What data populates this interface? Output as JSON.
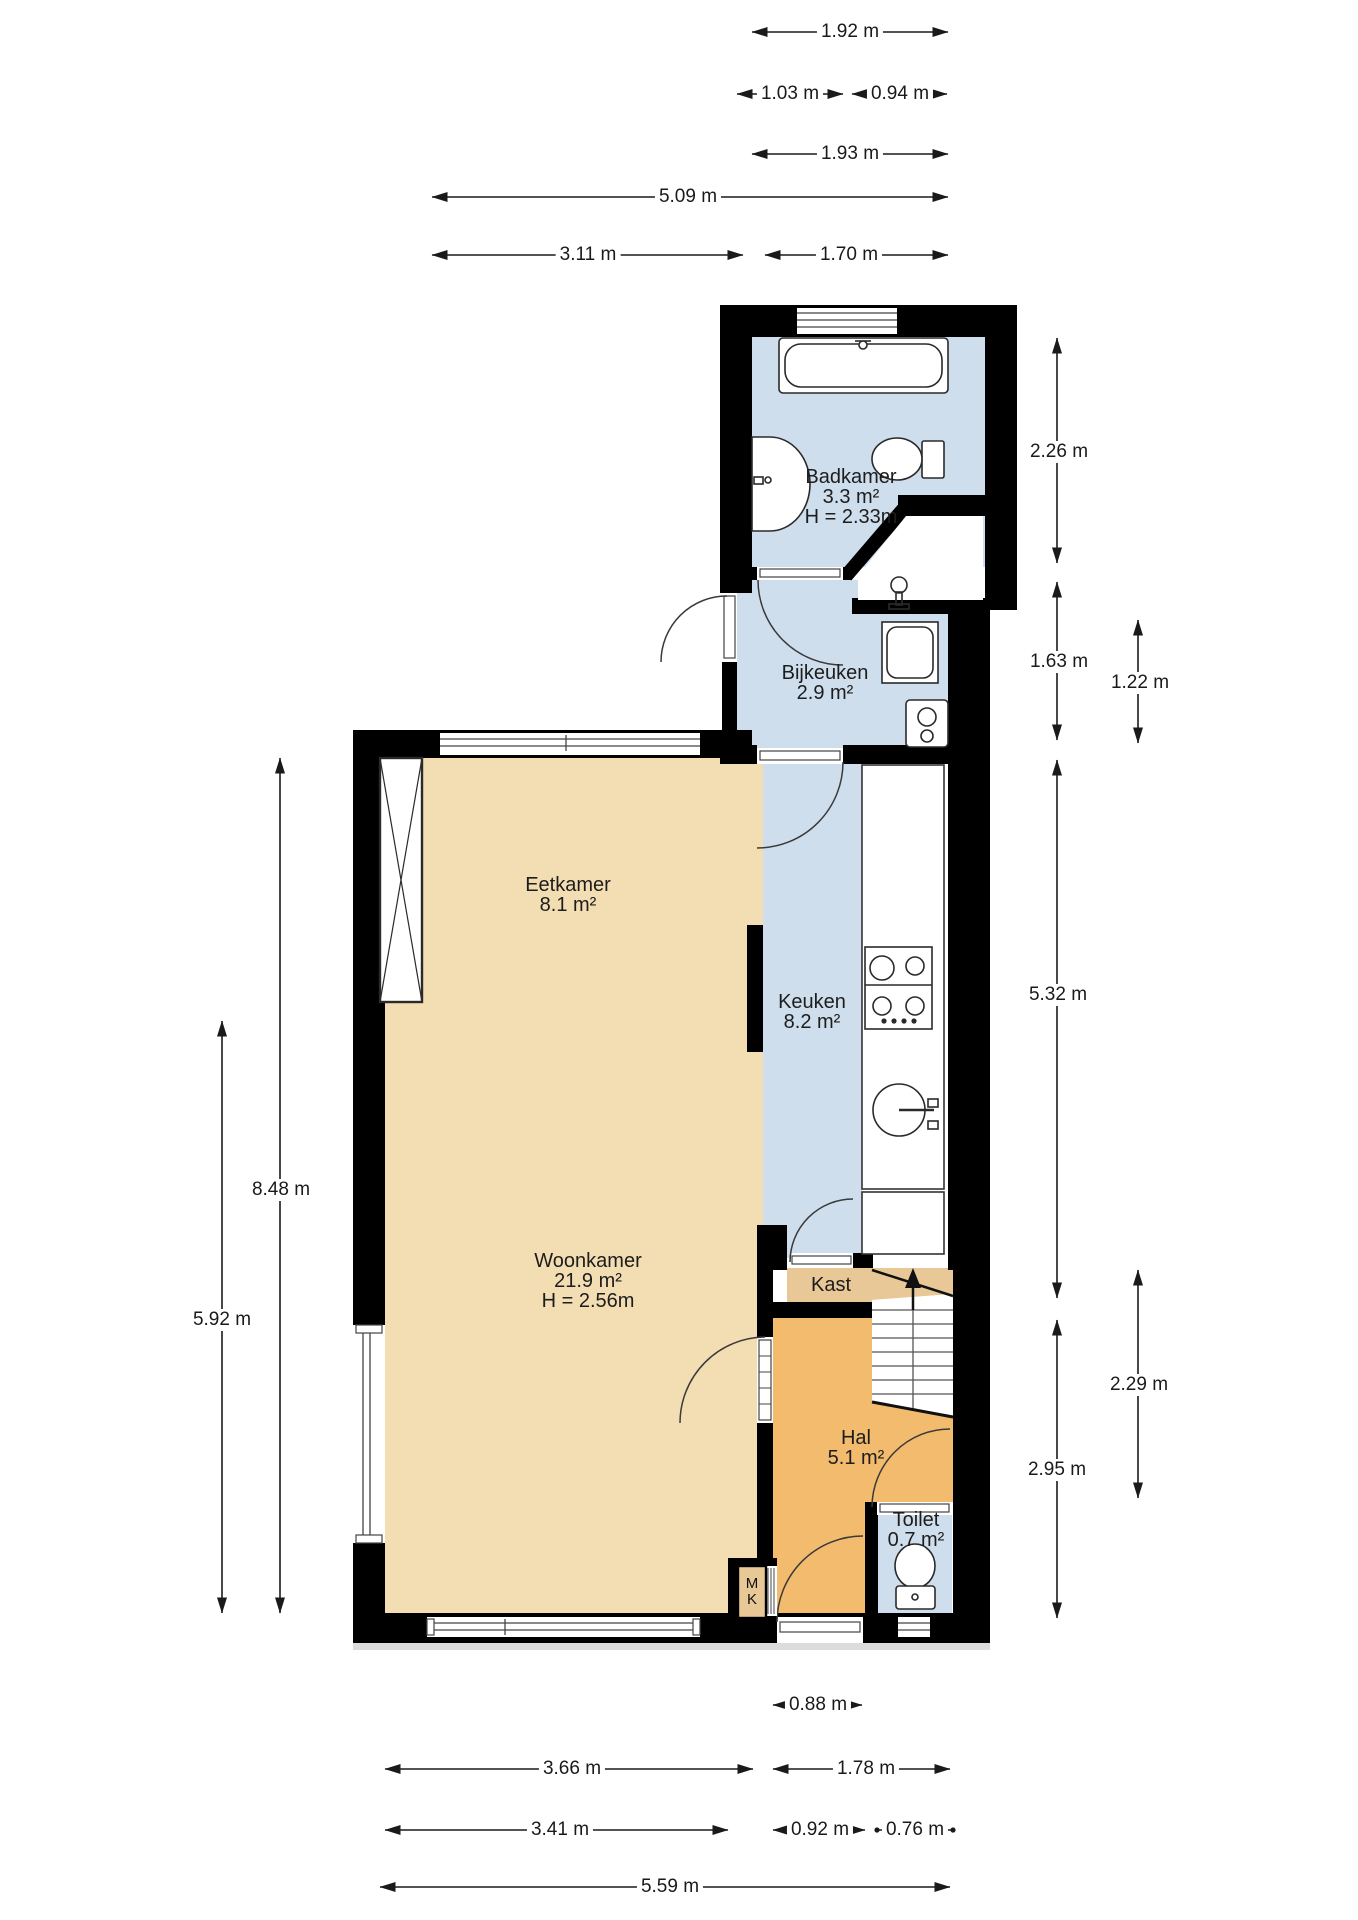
{
  "plan_type": "floorplan",
  "language": "nl",
  "rooms": {
    "badkamer": {
      "name": "Badkamer",
      "area": "3.3 m²",
      "ceiling": "H = 2.33m"
    },
    "bijkeuken": {
      "name": "Bijkeuken",
      "area": "2.9 m²"
    },
    "eetkamer": {
      "name": "Eetkamer",
      "area": "8.1 m²"
    },
    "keuken": {
      "name": "Keuken",
      "area": "8.2 m²"
    },
    "woonkamer": {
      "name": "Woonkamer",
      "area": "21.9 m²",
      "ceiling": "H = 2.56m"
    },
    "kast": {
      "name": "Kast"
    },
    "hal": {
      "name": "Hal",
      "area": "5.1 m²"
    },
    "toilet": {
      "name": "Toilet",
      "area": "0.7 m²"
    },
    "meterkast": {
      "line1": "M",
      "line2": "K"
    }
  },
  "dimensions": {
    "top": {
      "w192": "1.92 m",
      "w103": "1.03 m",
      "w094": "0.94 m",
      "w193": "1.93 m",
      "w509": "5.09 m",
      "w311": "3.11 m",
      "w170": "1.70 m"
    },
    "right": {
      "h226": "2.26 m",
      "h163": "1.63 m",
      "h122": "1.22 m",
      "h532": "5.32 m",
      "h229": "2.29 m",
      "h295": "2.95 m"
    },
    "left": {
      "h848": "8.48 m",
      "h592": "5.92 m"
    },
    "bottom": {
      "w088": "0.88 m",
      "w366": "3.66 m",
      "w178": "1.78 m",
      "w341": "3.41 m",
      "w092": "0.92 m",
      "w076": "0.76 m",
      "w559": "5.59 m"
    }
  },
  "icons": [
    "bathtub-icon",
    "washbasin-icon",
    "toilet-icon",
    "tap-icon",
    "washing-machine-icon",
    "boiler-icon",
    "stove-icon",
    "kitchen-sink-icon",
    "stairs-icon",
    "chimney-icon",
    "window-icon",
    "door-arc-icon",
    "up-arrow-icon"
  ],
  "colors": {
    "wall": "#000000",
    "living_floor": "#f3ddb3",
    "wet_floor": "#cfdeed",
    "hall_floor": "#f2bb6e",
    "closet_floor": "#e9c897",
    "fixture_stroke": "#2a2a2a",
    "dimension_text": "#1a1a1a"
  }
}
